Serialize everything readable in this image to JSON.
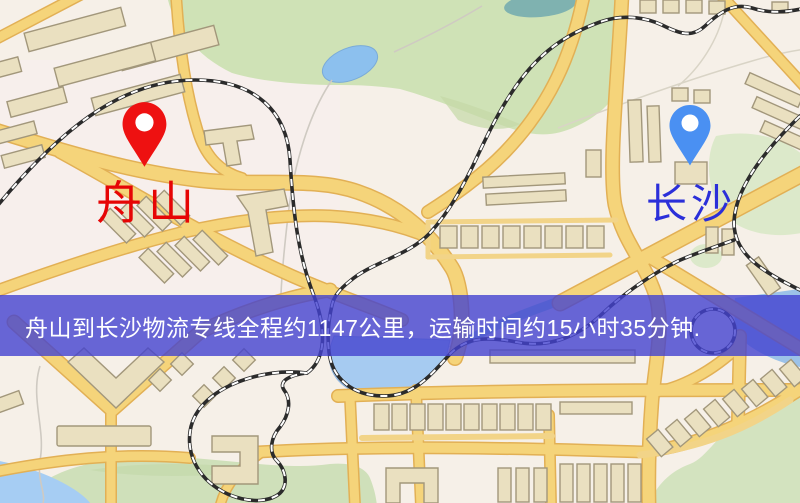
{
  "banner": {
    "text": "舟山到长沙物流专线全程约1147公里，运输时间约15小时35分钟.",
    "background_color": "#4442d0",
    "text_color": "#ffffff"
  },
  "markers": {
    "origin": {
      "name": "zhoushan",
      "label": "舟山",
      "pin_color": "#ee1111",
      "label_color": "#e60505"
    },
    "destination": {
      "name": "changsha",
      "label": "长沙",
      "pin_color": "#4a90f2",
      "label_color": "#2b2fd9"
    }
  },
  "route_info": {
    "origin_city": "舟山",
    "destination_city": "长沙",
    "distance_km": "1147",
    "duration": "15小时35分钟"
  },
  "map": {
    "colors": {
      "background": "#f6f0e8",
      "road_fill": "#f5d47a",
      "road_casing": "#e2b055",
      "building": "#eae0c0",
      "building_outline": "#a2977b",
      "park": "#cfe2b6",
      "water": "#a6cbf1",
      "railway_dark": "#2b2b2b",
      "railway_dash": "#ffffff"
    }
  }
}
